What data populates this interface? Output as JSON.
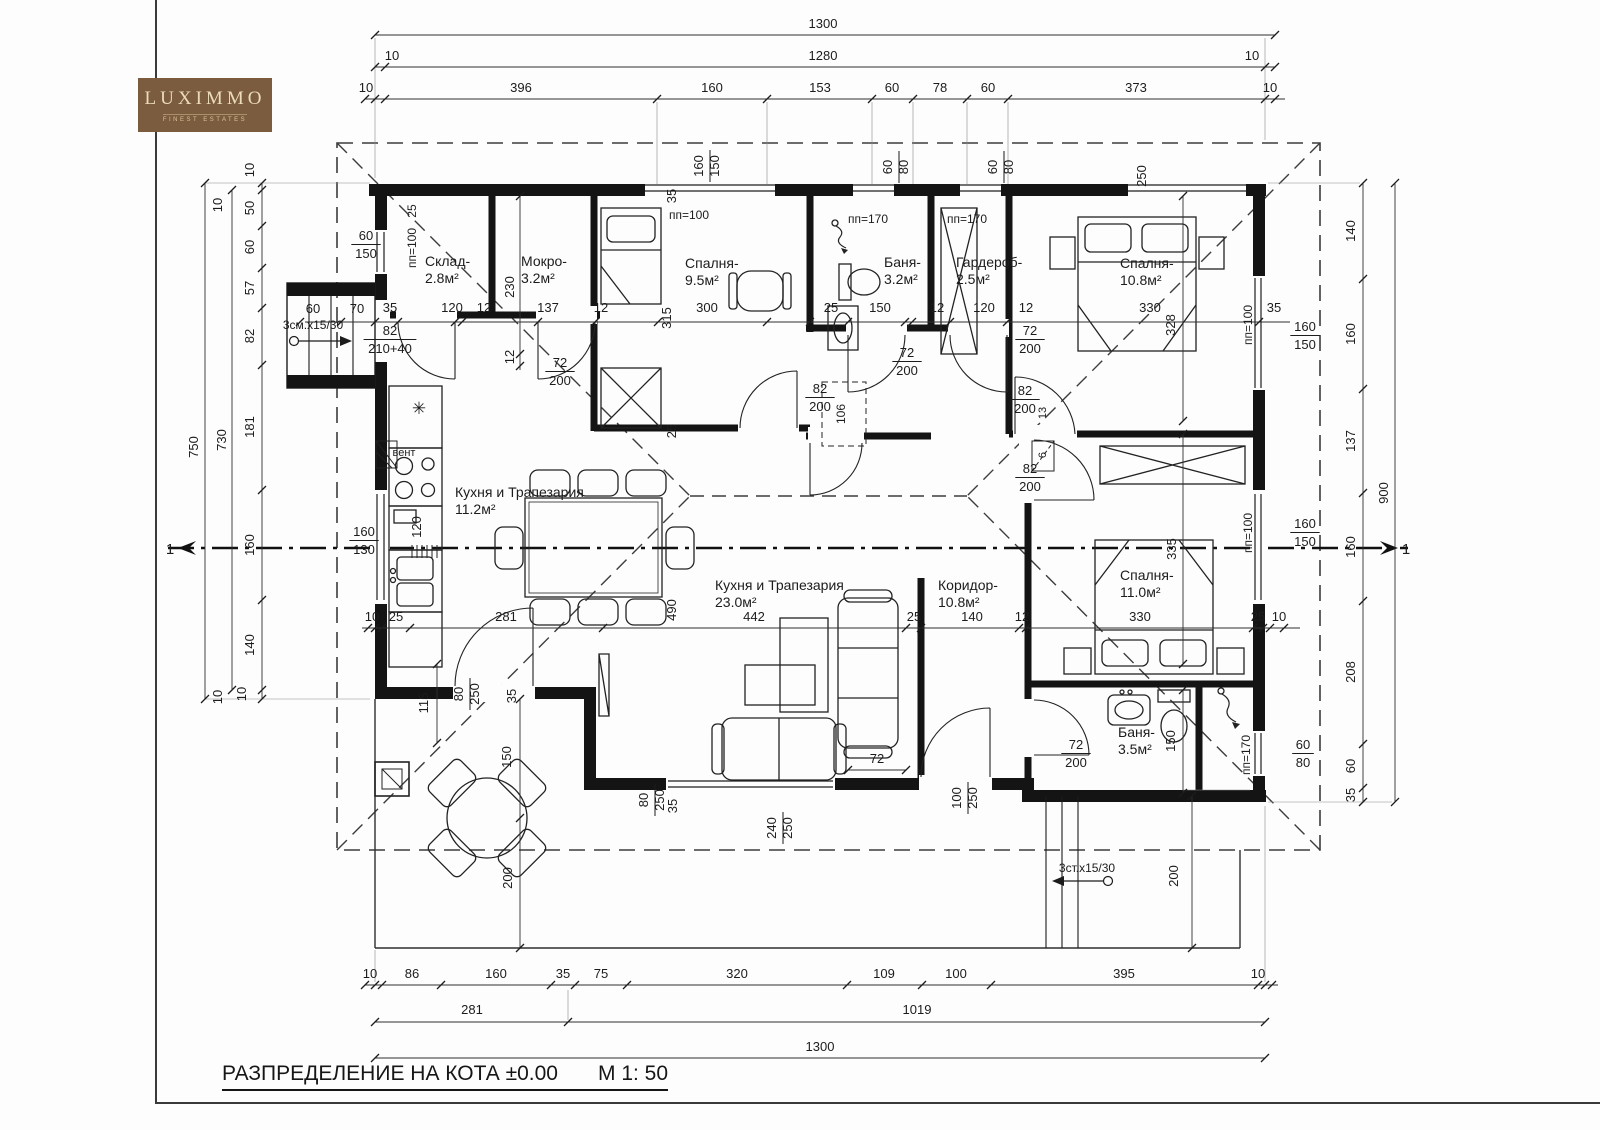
{
  "logo": {
    "name": "LUXIMMO",
    "tagline": "FINEST ESTATES"
  },
  "title": {
    "text": "РАЗПРЕДЕЛЕНИЕ НА КОТА ±0.00",
    "scale": "М 1: 50"
  },
  "colors": {
    "wall": "#141414",
    "line": "#2f2f2f",
    "logo_bg": "#7b5c3e",
    "logo_text": "#ecdcba"
  },
  "rooms": [
    {
      "name": "Склад-",
      "area": "2.8м²",
      "x": 425,
      "y": 266
    },
    {
      "name": "Мокро-",
      "area": "3.2м²",
      "x": 521,
      "y": 266
    },
    {
      "name": "Спалня-",
      "area": "9.5м²",
      "x": 685,
      "y": 268
    },
    {
      "name": "Баня-",
      "area": "3.2м²",
      "x": 884,
      "y": 267
    },
    {
      "name": "Гардероб-",
      "area": "2.5м²",
      "x": 956,
      "y": 267
    },
    {
      "name": "Спалня-",
      "area": "10.8м²",
      "x": 1120,
      "y": 268
    },
    {
      "name": "Кухня и Трапезария",
      "area": "11.2м²",
      "x": 455,
      "y": 497
    },
    {
      "name": "Кухня и Трапезария",
      "area": "23.0м²",
      "x": 715,
      "y": 590
    },
    {
      "name": "Коридор-",
      "area": "10.8м²",
      "x": 938,
      "y": 590
    },
    {
      "name": "Спалня-",
      "area": "11.0м²",
      "x": 1120,
      "y": 580
    },
    {
      "name": "Баня-",
      "area": "3.5м²",
      "x": 1118,
      "y": 737
    }
  ],
  "dims": [
    {
      "t": "1300",
      "x": 823,
      "y": 28
    },
    {
      "t": "10",
      "x": 392,
      "y": 60
    },
    {
      "t": "1280",
      "x": 823,
      "y": 60
    },
    {
      "t": "10",
      "x": 1252,
      "y": 60
    },
    {
      "t": "10",
      "x": 366,
      "y": 92
    },
    {
      "t": "396",
      "x": 521,
      "y": 92
    },
    {
      "t": "160",
      "x": 712,
      "y": 92
    },
    {
      "t": "153",
      "x": 820,
      "y": 92
    },
    {
      "t": "60",
      "x": 892,
      "y": 92
    },
    {
      "t": "78",
      "x": 940,
      "y": 92
    },
    {
      "t": "60",
      "x": 988,
      "y": 92
    },
    {
      "t": "373",
      "x": 1136,
      "y": 92
    },
    {
      "t": "10",
      "x": 1270,
      "y": 92
    },
    {
      "t": "10",
      "x": 370,
      "y": 978
    },
    {
      "t": "86",
      "x": 412,
      "y": 978
    },
    {
      "t": "160",
      "x": 496,
      "y": 978
    },
    {
      "t": "35",
      "x": 563,
      "y": 978
    },
    {
      "t": "75",
      "x": 601,
      "y": 978
    },
    {
      "t": "320",
      "x": 737,
      "y": 978
    },
    {
      "t": "109",
      "x": 884,
      "y": 978
    },
    {
      "t": "100",
      "x": 956,
      "y": 978
    },
    {
      "t": "395",
      "x": 1124,
      "y": 978
    },
    {
      "t": "10",
      "x": 1258,
      "y": 978
    },
    {
      "t": "281",
      "x": 472,
      "y": 1014
    },
    {
      "t": "1019",
      "x": 917,
      "y": 1014
    },
    {
      "t": "1300",
      "x": 820,
      "y": 1051
    },
    {
      "t": "10",
      "x": 254,
      "y": 170,
      "r": -90
    },
    {
      "t": "50",
      "x": 254,
      "y": 208,
      "r": -90
    },
    {
      "t": "60",
      "x": 254,
      "y": 247,
      "r": -90
    },
    {
      "t": "57",
      "x": 254,
      "y": 288,
      "r": -90
    },
    {
      "t": "82",
      "x": 254,
      "y": 336,
      "r": -90
    },
    {
      "t": "181",
      "x": 254,
      "y": 427,
      "r": -90
    },
    {
      "t": "160",
      "x": 254,
      "y": 545,
      "r": -90
    },
    {
      "t": "140",
      "x": 254,
      "y": 645,
      "r": -90
    },
    {
      "t": "10",
      "x": 246,
      "y": 694,
      "r": -90
    },
    {
      "t": "10",
      "x": 222,
      "y": 205,
      "r": -90
    },
    {
      "t": "10",
      "x": 222,
      "y": 697,
      "r": -90
    },
    {
      "t": "750",
      "x": 198,
      "y": 447,
      "r": -90
    },
    {
      "t": "730",
      "x": 226,
      "y": 440,
      "r": -90
    },
    {
      "t": "140",
      "x": 1355,
      "y": 231,
      "r": -90
    },
    {
      "t": "160",
      "x": 1355,
      "y": 334,
      "r": -90
    },
    {
      "t": "137",
      "x": 1355,
      "y": 441,
      "r": -90
    },
    {
      "t": "160",
      "x": 1355,
      "y": 547,
      "r": -90
    },
    {
      "t": "208",
      "x": 1355,
      "y": 672,
      "r": -90
    },
    {
      "t": "60",
      "x": 1355,
      "y": 766,
      "r": -90
    },
    {
      "t": "35",
      "x": 1355,
      "y": 795,
      "r": -90
    },
    {
      "t": "900",
      "x": 1388,
      "y": 493,
      "r": -90
    },
    {
      "t": "35",
      "x": 390,
      "y": 312
    },
    {
      "t": "120",
      "x": 452,
      "y": 312
    },
    {
      "t": "12",
      "x": 484,
      "y": 312
    },
    {
      "t": "137",
      "x": 548,
      "y": 312
    },
    {
      "t": "12",
      "x": 601,
      "y": 312
    },
    {
      "t": "300",
      "x": 707,
      "y": 312
    },
    {
      "t": "25",
      "x": 831,
      "y": 312
    },
    {
      "t": "150",
      "x": 880,
      "y": 312
    },
    {
      "t": "12",
      "x": 937,
      "y": 312
    },
    {
      "t": "120",
      "x": 984,
      "y": 312
    },
    {
      "t": "12",
      "x": 1026,
      "y": 312
    },
    {
      "t": "330",
      "x": 1150,
      "y": 312
    },
    {
      "t": "35",
      "x": 1274,
      "y": 312
    },
    {
      "t": "60",
      "x": 313,
      "y": 313
    },
    {
      "t": "70",
      "x": 357,
      "y": 313
    },
    {
      "t": "10",
      "x": 372,
      "y": 621
    },
    {
      "t": "25",
      "x": 396,
      "y": 621
    },
    {
      "t": "281",
      "x": 506,
      "y": 621
    },
    {
      "t": "442",
      "x": 754,
      "y": 621
    },
    {
      "t": "25",
      "x": 914,
      "y": 621
    },
    {
      "t": "140",
      "x": 972,
      "y": 621
    },
    {
      "t": "12",
      "x": 1022,
      "y": 621
    },
    {
      "t": "330",
      "x": 1140,
      "y": 621
    },
    {
      "t": "25",
      "x": 1258,
      "y": 621
    },
    {
      "t": "10",
      "x": 1279,
      "y": 621
    },
    {
      "t": "230",
      "x": 514,
      "y": 287,
      "r": -90
    },
    {
      "t": "12",
      "x": 514,
      "y": 357,
      "r": -90
    },
    {
      "t": "120",
      "x": 421,
      "y": 527,
      "r": -90
    },
    {
      "t": "115",
      "x": 428,
      "y": 703,
      "r": -90
    },
    {
      "t": "315",
      "x": 671,
      "y": 318,
      "r": -90
    },
    {
      "t": "35",
      "x": 676,
      "y": 196,
      "r": -90
    },
    {
      "t": "25",
      "x": 676,
      "y": 431,
      "r": -90
    },
    {
      "t": "490",
      "x": 676,
      "y": 610,
      "r": -90
    },
    {
      "t": "106",
      "x": 845,
      "y": 414,
      "r": -90,
      "s": 12
    },
    {
      "t": "13",
      "x": 1046,
      "y": 413,
      "r": -90,
      "s": 11
    },
    {
      "t": "6",
      "x": 1046,
      "y": 455,
      "r": -90,
      "s": 11
    },
    {
      "t": "328",
      "x": 1175,
      "y": 325,
      "r": -90
    },
    {
      "t": "335",
      "x": 1176,
      "y": 549,
      "r": -90
    },
    {
      "t": "250",
      "x": 1146,
      "y": 176,
      "r": -90
    },
    {
      "t": "150",
      "x": 1175,
      "y": 741,
      "r": -90
    },
    {
      "t": "150",
      "x": 511,
      "y": 757,
      "r": -90
    },
    {
      "t": "200",
      "x": 512,
      "y": 878,
      "r": -90
    },
    {
      "t": "200",
      "x": 1178,
      "y": 876,
      "r": -90
    },
    {
      "t": "35",
      "x": 677,
      "y": 806,
      "r": -90
    },
    {
      "t": "35",
      "x": 516,
      "y": 696,
      "r": -90
    },
    {
      "t": "72",
      "x": 877,
      "y": 763
    }
  ],
  "annotations": [
    {
      "t": "пп=100",
      "x": 416,
      "y": 248,
      "r": -90,
      "s": 12
    },
    {
      "t": "25",
      "x": 416,
      "y": 211,
      "r": -90,
      "s": 12
    },
    {
      "t": "пп=100",
      "x": 689,
      "y": 219,
      "s": 12
    },
    {
      "t": "пп=170",
      "x": 868,
      "y": 223,
      "s": 12
    },
    {
      "t": "пп=170",
      "x": 967,
      "y": 223,
      "s": 12
    },
    {
      "t": "пп=100",
      "x": 1252,
      "y": 325,
      "r": -90,
      "s": 12
    },
    {
      "t": "пп=100",
      "x": 1252,
      "y": 533,
      "r": -90,
      "s": 12
    },
    {
      "t": "пп=170",
      "x": 1250,
      "y": 755,
      "r": -90,
      "s": 12
    },
    {
      "t": "вент",
      "x": 404,
      "y": 456,
      "s": 11
    },
    {
      "t": "✳",
      "x": 419,
      "y": 414,
      "s": 17
    },
    {
      "t": "3см.x15/30",
      "x": 313,
      "y": 329,
      "s": 12
    },
    {
      "t": "3ст.x15/30",
      "x": 1087,
      "y": 872,
      "s": 12
    },
    {
      "t": "1",
      "x": 170,
      "y": 554,
      "s": 15
    },
    {
      "t": "1",
      "x": 1406,
      "y": 554,
      "s": 15
    }
  ],
  "fractions": [
    {
      "n": "60",
      "d": "150",
      "x": 366,
      "y": 243
    },
    {
      "n": "82",
      "d": "210+40",
      "x": 390,
      "y": 338
    },
    {
      "n": "160",
      "d": "130",
      "x": 364,
      "y": 539
    },
    {
      "n": "72",
      "d": "200",
      "x": 560,
      "y": 370
    },
    {
      "n": "72",
      "d": "200",
      "x": 907,
      "y": 360
    },
    {
      "n": "82",
      "d": "200",
      "x": 820,
      "y": 396
    },
    {
      "n": "72",
      "d": "200",
      "x": 1030,
      "y": 338
    },
    {
      "n": "82",
      "d": "200",
      "x": 1025,
      "y": 398
    },
    {
      "n": "82",
      "d": "200",
      "x": 1030,
      "y": 476
    },
    {
      "n": "72",
      "d": "200",
      "x": 1076,
      "y": 752
    },
    {
      "n": "160",
      "d": "150",
      "x": 1305,
      "y": 334
    },
    {
      "n": "160",
      "d": "150",
      "x": 1305,
      "y": 531
    },
    {
      "n": "60",
      "d": "80",
      "x": 1303,
      "y": 752
    },
    {
      "n": "60",
      "d": "80",
      "x": 899,
      "y": 167,
      "v": true
    },
    {
      "n": "60",
      "d": "80",
      "x": 1004,
      "y": 167,
      "v": true
    },
    {
      "n": "160",
      "d": "150",
      "x": 710,
      "y": 166,
      "v": true
    },
    {
      "n": "240",
      "d": "250",
      "x": 783,
      "y": 828,
      "v": true
    },
    {
      "n": "100",
      "d": "250",
      "x": 968,
      "y": 798,
      "v": true
    },
    {
      "n": "80",
      "d": "250",
      "x": 655,
      "y": 800,
      "v": true
    },
    {
      "n": "80",
      "d": "250",
      "x": 470,
      "y": 694,
      "v": true
    }
  ]
}
